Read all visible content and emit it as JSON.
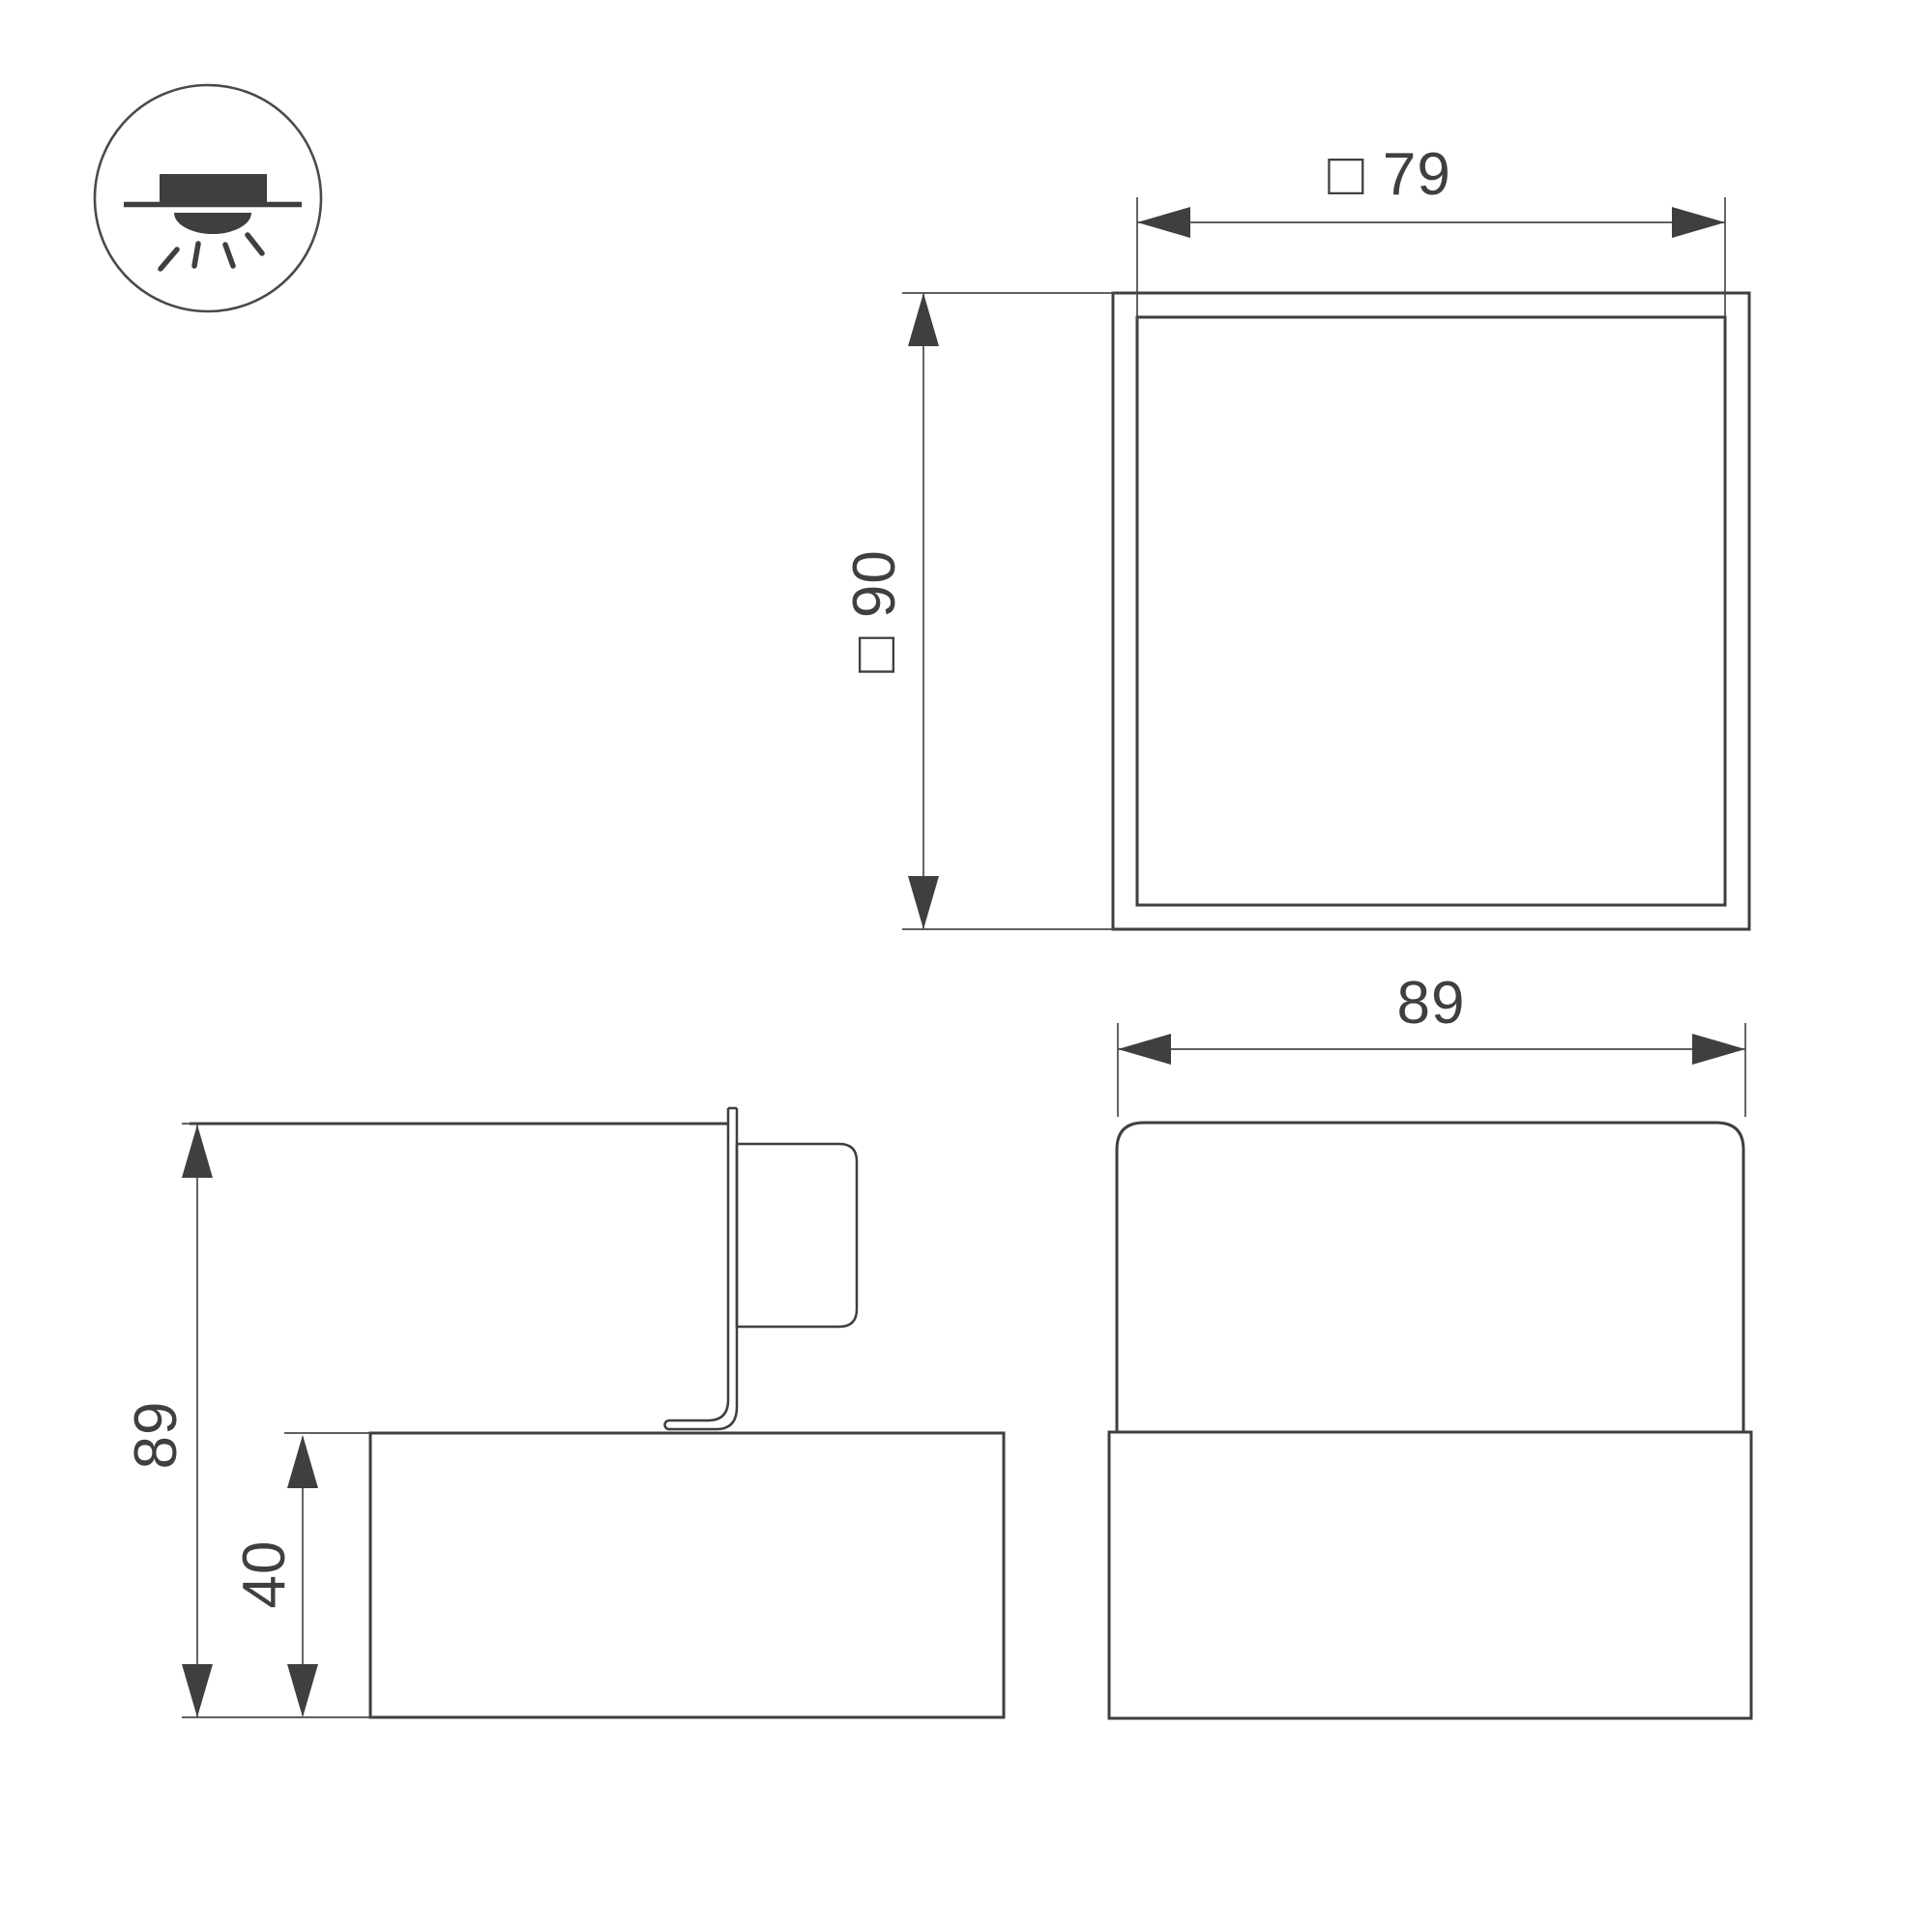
{
  "background": "#ffffff",
  "line_color": "#3f3f3f",
  "icon": {
    "name": "recessed-mounted-luminaire-icon"
  },
  "views": {
    "top": {
      "name": "top-view",
      "label_width": "□ 79",
      "label_height": "□ 90"
    },
    "front": {
      "name": "front-view",
      "label_width": "89"
    },
    "side": {
      "name": "side-view",
      "label_height": "89",
      "label_base_height": "40"
    }
  },
  "dimension_values": {
    "body_face_square": 79,
    "body_outer_square": 90,
    "overall_width": 89,
    "overall_height": 89,
    "base_height": 40
  }
}
